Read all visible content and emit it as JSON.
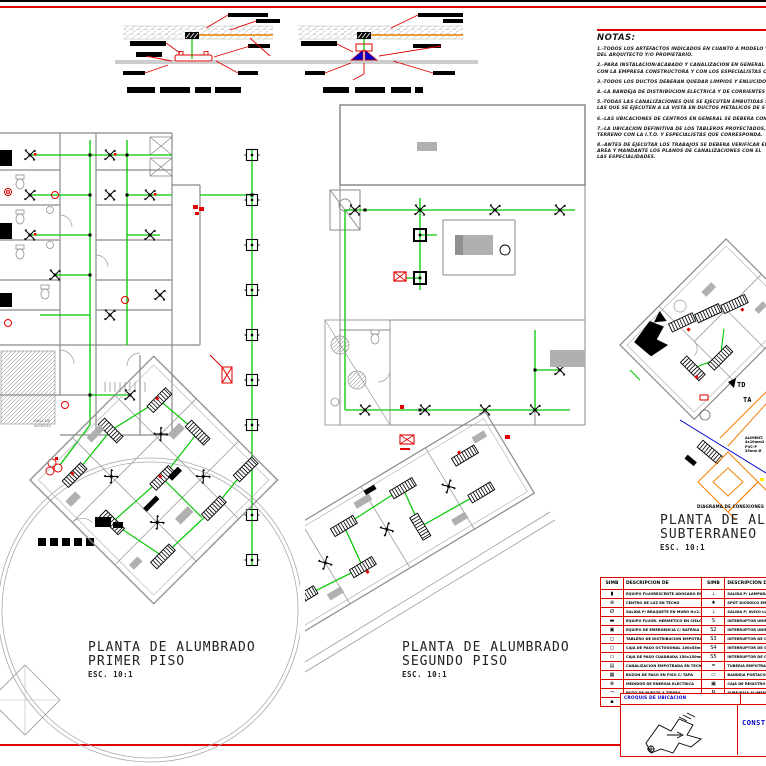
{
  "sheet": {
    "accent_red": "#e00000",
    "circuit_green": "#00c800",
    "wall_gray": "#8a8a8a",
    "orange": "#f08000",
    "blue": "#0000cc"
  },
  "titles": {
    "plan1": {
      "line1": "PLANTA DE ALUMBRADO",
      "line2": "PRIMER PISO",
      "scale": "ESC. 10:1"
    },
    "plan2": {
      "line1": "PLANTA DE ALUMBRADO",
      "line2": "SEGUNDO PISO",
      "scale": "ESC. 10:1"
    },
    "plan3": {
      "line1": "PLANTA DE ALUMBRADO",
      "line2": "SUBTERRANEO",
      "scale": "ESC. 10:1"
    }
  },
  "notes": {
    "title": "NOTAS:",
    "items": [
      "1.-TODOS LOS ARTEFACTOS INDICADOS EN CUANTO A MODELO Y\nDEL ARQUITECTO Y/O PROPIETARIO.",
      "2.-PARA INSTALACION/ACABADO Y CANALIZACION EN GENERAL S\nCON LA EMPRESA CONSTRUCTORA Y CON LOS ESPECIALISTAS C",
      "3.-TODOS LOS DUCTOS DEBERAN QUEDAR LIMPIOS Y ENLUCIDOS",
      "4.-LA BANDEJA DE DISTRIBUCION ELECTRICA Y DE CORRIENTES D",
      "5.-TODAS LAS CANALIZACIONES QUE SE EJECUTEN EMBUTIDAS SE\nLAS QUE SE EJECUTEN A LA VISTA EN DUCTOS METALICOS DE S",
      "6.-LAS UBICACIONES DE CENTROS EN GENERAL SE DEBERA CONF",
      "7.-LA UBICACION DEFINITIVA DE LOS TABLEROS PROYECTADOS, SE\nTERRENO CON LA I.T.O. Y ESPECIALISTAS QUE CORRESPONDA.",
      "8.-ANTES DE EJECUTAR LOS TRABAJOS SE DEBERA VERIFICAR EN\nAREA Y MANDANTE LOS PLANOS DE CANALIZACIONES CON EL\nLAS ESPECIALIDADES."
    ]
  },
  "legend": {
    "headers": [
      "SIMB",
      "DESCRIPCION DE SIMBOLOGIA",
      "SIMB",
      "DESCRIPCION DE SIMBOLOGIA"
    ],
    "rows": [
      {
        "s1": "▮",
        "d1": "EQUIPO FLUORESCENTE ADOSADO EN CIELO RASO",
        "s2": "⊥",
        "d2": "SALIDA P/ LAMPARA DE EMERGENCIA"
      },
      {
        "s1": "⊕",
        "d1": "CENTRO DE LUZ EN TECHO",
        "s2": "♦",
        "d2": "SPOT DICROICO EMPOTRADO EN CIELO"
      },
      {
        "s1": "Ø",
        "d1": "SALIDA P/ BRAQUETE EN MURO H=2.20",
        "s2": "⊥",
        "d2": "SALIDA P/ AVISO LUMINOSO"
      },
      {
        "s1": "▬",
        "d1": "EQUIPO FLUOR. HERMETICO EN CIELO",
        "s2": "S",
        "d2": "INTERRUPTOR UNIPOLAR SIMPLE H=1.40"
      },
      {
        "s1": "▣",
        "d1": "EQUIPO DE EMERGENCIA C/ BATERIA 2 LAMP.",
        "s2": "S2",
        "d2": "INTERRUPTOR UNIPOLAR DOBLE H=1.40"
      },
      {
        "s1": "◻",
        "d1": "TABLERO DE DISTRIBUCION EMPOTRADO",
        "s2": "S3",
        "d2": "INTERRUPTOR DE CONMUTACION SIMPLE"
      },
      {
        "s1": "○",
        "d1": "CAJA DE PASO OCTOGONAL 100x55mm",
        "s2": "S4",
        "d2": "INTERRUPTOR DE CONMUTACION DOBLE"
      },
      {
        "s1": "▭",
        "d1": "CAJA DE PASO CUADRADA 150x150mm",
        "s2": "S5",
        "d2": "INTERRUPTOR DE CONMUTACION TRIPLE"
      },
      {
        "s1": "▤",
        "d1": "CANALIZACION EMPOTRADA EN TECHO O MURO",
        "s2": "=",
        "d2": "TUBERIA EMPOTRADA EN PISO"
      },
      {
        "s1": "▦",
        "d1": "BUZON DE PASO EN PISO C/ TAPA",
        "s2": "▭",
        "d2": "BANDEJA PORTACONDUCTORES"
      },
      {
        "s1": "⊗",
        "d1": "MEDIDOR DE ENERGIA ELECTRICA",
        "s2": "▣",
        "d2": "CAJA DE REGISTRO EN PISO"
      },
      {
        "s1": "¬",
        "d1": "POZO DE PUESTA A TIERRA",
        "s2": "N",
        "d2": "SUBE/BAJA ALIMENTADOR"
      },
      {
        "s1": "▪",
        "d1": "SALIDA ESPECIAL A PRUEBA DE HUMEDAD",
        "s2": "→",
        "d2": "VIENE/VA CIRCUITO"
      }
    ]
  },
  "titleblock": {
    "location_label": "CROQUIS DE UBICACION",
    "right_text": "CONST"
  },
  "plan_labels": {
    "hall": "HALL DE\nINGRESO",
    "td": "TD",
    "ta": "TA",
    "feeder": "ALIMENT.\n4x10mm2\nPVC-P\n25mm Ø",
    "diagram_caption": "DIAGRAMA DE CONEXIONES"
  }
}
